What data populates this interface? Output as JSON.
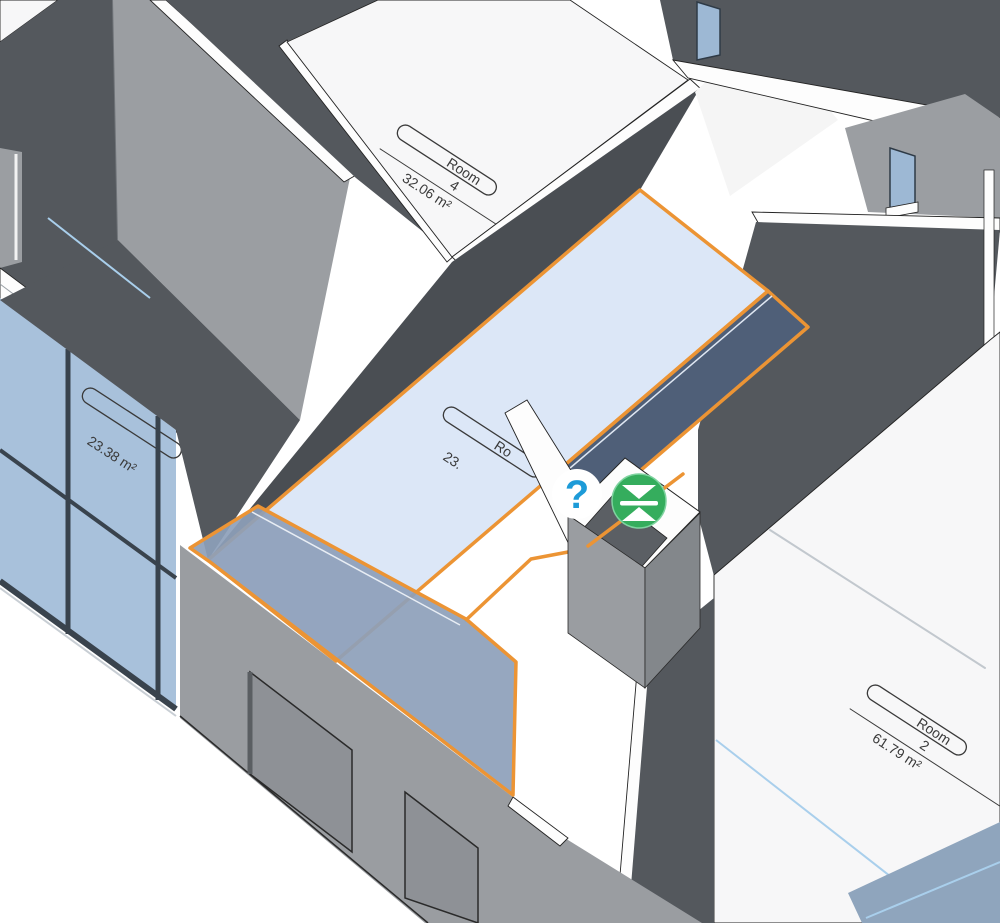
{
  "view": {
    "type": "3d-isometric-building-view",
    "selection_color": "#ec9434",
    "selection_fill": "#dce7f7",
    "wall_dark": "#54585d",
    "wall_light": "#9b9ea2",
    "glass_color": "#a8c1db"
  },
  "rooms": [
    {
      "name": "Room",
      "number": "4",
      "area": "32.06 m²"
    },
    {
      "name": "Room",
      "number": "2",
      "area": "61.79 m²"
    },
    {
      "name": "",
      "number": "",
      "area": "23.38 m²"
    },
    {
      "name": "Ro",
      "number": "",
      "area": "23.",
      "selected": true
    }
  ],
  "icons": {
    "help": {
      "glyph": "?",
      "color": "#1d9bd8",
      "bg": "#ffffff"
    },
    "flip": {
      "semantic": "flip-collapse-control",
      "bg": "#35ad5d",
      "fg": "#ffffff"
    }
  }
}
